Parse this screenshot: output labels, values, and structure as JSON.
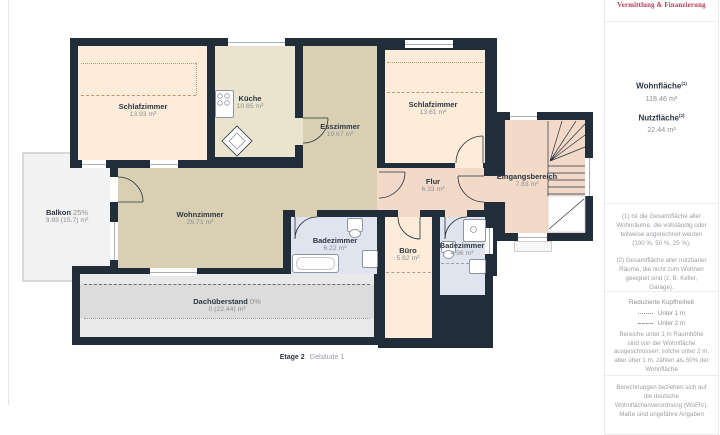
{
  "branding": {
    "logo": "Vermittlung & Finanzierung",
    "logo_color": "#b23a52"
  },
  "sidebar": {
    "stats": {
      "wohnflaeche_label": "Wohnfläche",
      "wohnflaeche_sup": "(1)",
      "wohnflaeche_value": "118.46 m²",
      "nutzflaeche_label": "Nutzfläche",
      "nutzflaeche_sup": "(2)",
      "nutzflaeche_value": "22.44 m²"
    },
    "note1": "(1) Ist die Gesamtfläche aller Wohnräume, die vollständig oder teilweise angerechnet werden (100 %, 50 %, 25 %).",
    "note2": "(2) Gesamtfläche aller nutzbaren Räume, die nicht zum Wohnen geeignet sind (z. B. Keller, Garage).",
    "headroom_title": "Reduzierte Kopffreiheit",
    "legend1": "Unter 1 m",
    "legend2": "Unter 2 m",
    "headroom_text": "Bereiche unter 1 m Raumhöhe sind von der Wohnfläche ausgeschlossen; solche unter 2 m, aber über 1 m, zählen als 50% der Wohnfläche",
    "disclaimer": "Berechnungen beziehen sich auf die deutsche Wohnflächenverordnung (WoFlV). Maße sind ungefähre Angaben"
  },
  "plan": {
    "rooms": {
      "schlafzimmer1": {
        "name": "Schlafzimmer",
        "area": "13.93 m²"
      },
      "kueche": {
        "name": "Küche",
        "area": "10.65 m²"
      },
      "esszimmer": {
        "name": "Esszimmer",
        "area": "19.67 m²"
      },
      "schlafzimmer2": {
        "name": "Schlafzimmer",
        "area": "13.61 m²"
      },
      "wohnzimmer": {
        "name": "Wohnzimmer",
        "area": "25.71 m²"
      },
      "flur": {
        "name": "Flur",
        "area": "6.33 m²"
      },
      "eingangsbereich": {
        "name": "Eingangsbereich",
        "area": "7.83 m²"
      },
      "badezimmer1": {
        "name": "Badezimmer",
        "area": "6.22 m²"
      },
      "buero": {
        "name": "Büro",
        "area": "5.62 m²"
      },
      "badezimmer2": {
        "name": "Badezimmer",
        "area": "4.96 m²"
      },
      "balkon": {
        "name": "Balkon",
        "factor": "25%",
        "area": "3.93 (15.7) m²"
      },
      "dachueberstand": {
        "name": "Dachüberstand",
        "factor": "0%",
        "area": "0 (22.44) m²"
      }
    },
    "footer": {
      "floor": "Etage 2",
      "building": "Gebäude 1"
    },
    "colors": {
      "wall": "#212e3a",
      "bedroom": "#fcecd9",
      "kitchen": "#eae3cd",
      "living": "#d9d0b4",
      "hall": "#f3d9c8",
      "bath": "#dfe4ef",
      "balcony": "#f2f2f2",
      "roof_overhang": "#dcdcdc"
    }
  }
}
